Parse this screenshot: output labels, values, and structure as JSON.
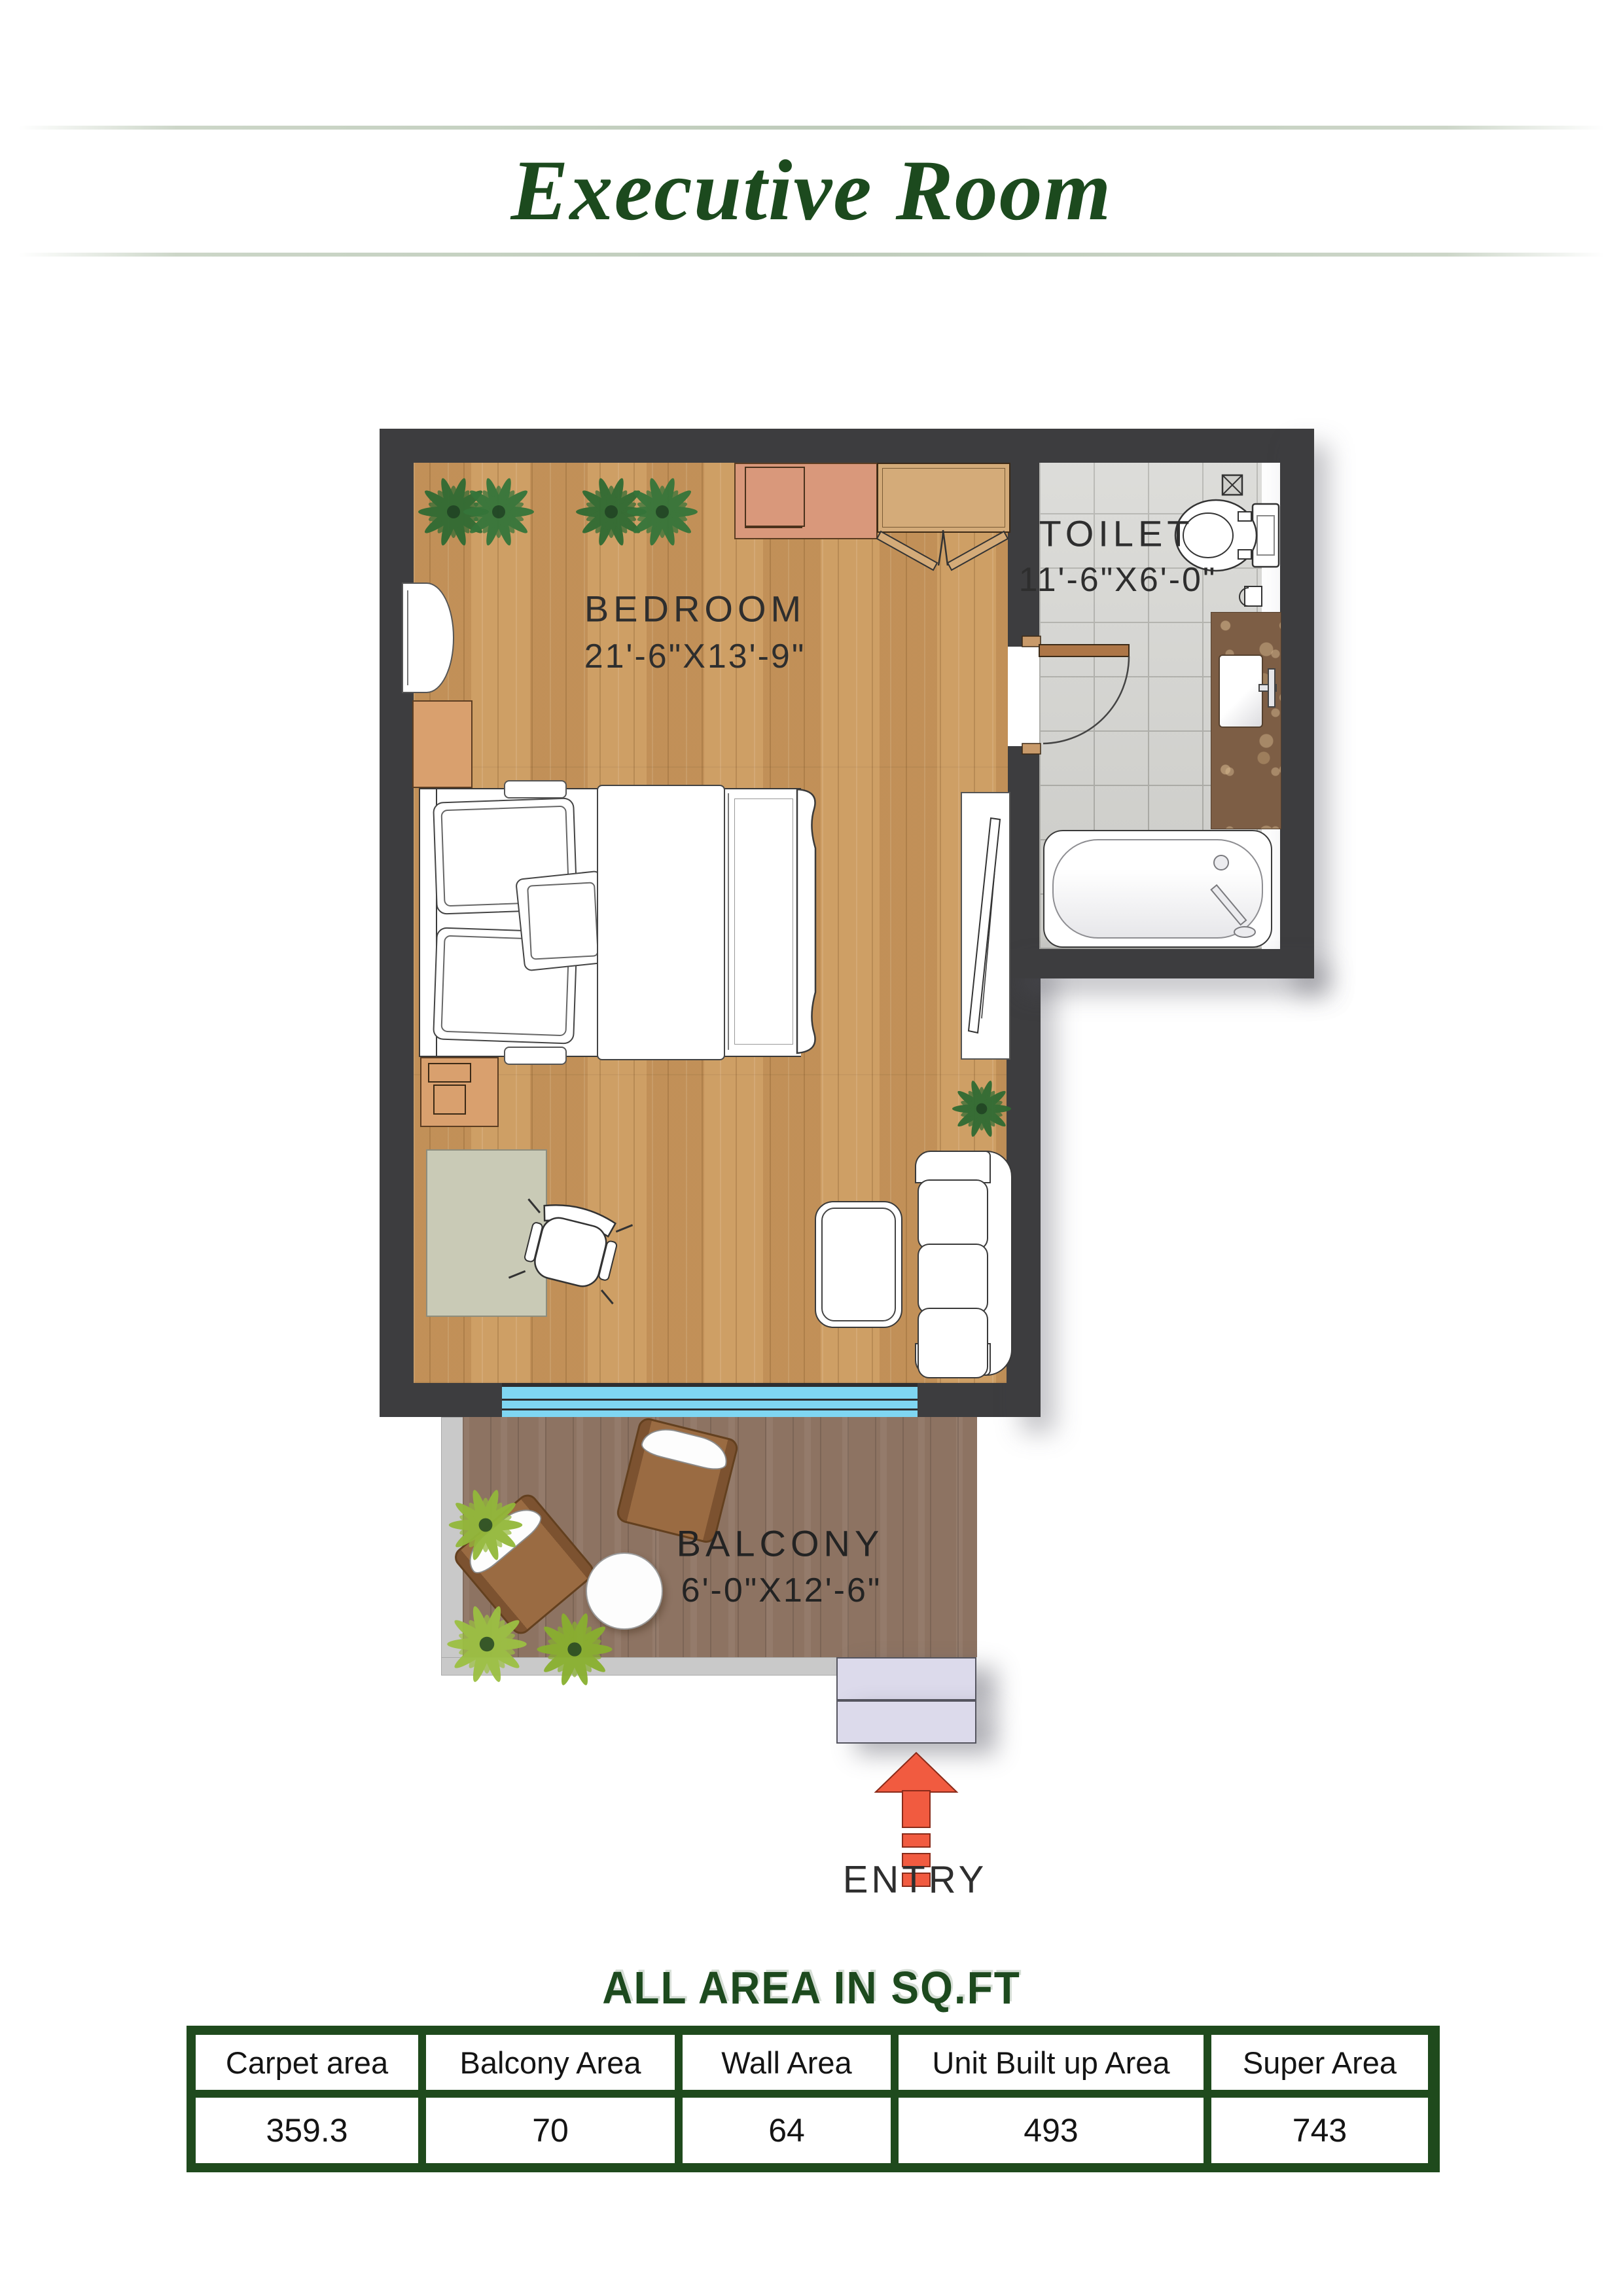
{
  "page": {
    "title": "Executive Room"
  },
  "plan": {
    "rooms": {
      "bedroom": {
        "label": "BEDROOM",
        "dims": "21'-6\"X13'-9\""
      },
      "toilet": {
        "label": "TOILET",
        "dims": "11'-6\"X6'-0\""
      },
      "balcony": {
        "label": "BALCONY",
        "dims": "6'-0\"X12'-6\""
      }
    },
    "entry_label": "ENTRY",
    "icons": [
      "plant-icon",
      "entry-arrow-icon",
      "floor-drain-icon"
    ]
  },
  "area_table": {
    "heading": "ALL AREA IN SQ.FT",
    "headers": [
      "Carpet area",
      "Balcony Area",
      "Wall Area",
      "Unit Built up Area",
      "Super Area"
    ],
    "values": [
      "359.3",
      "70",
      "64",
      "493",
      "743"
    ]
  },
  "colors": {
    "accent_green": "#1d4a1e",
    "wall": "#3d3d3f",
    "bedroom_wood": "#c9985e",
    "balcony_wood": "#8d7362",
    "tile": "#d3d3cf",
    "window_blue": "#7fd6f2",
    "entry_step": "#dcdaeb",
    "arrow_red": "#f15b40",
    "furniture_tan": "#d9a06e",
    "marble": "#7d5e45"
  }
}
